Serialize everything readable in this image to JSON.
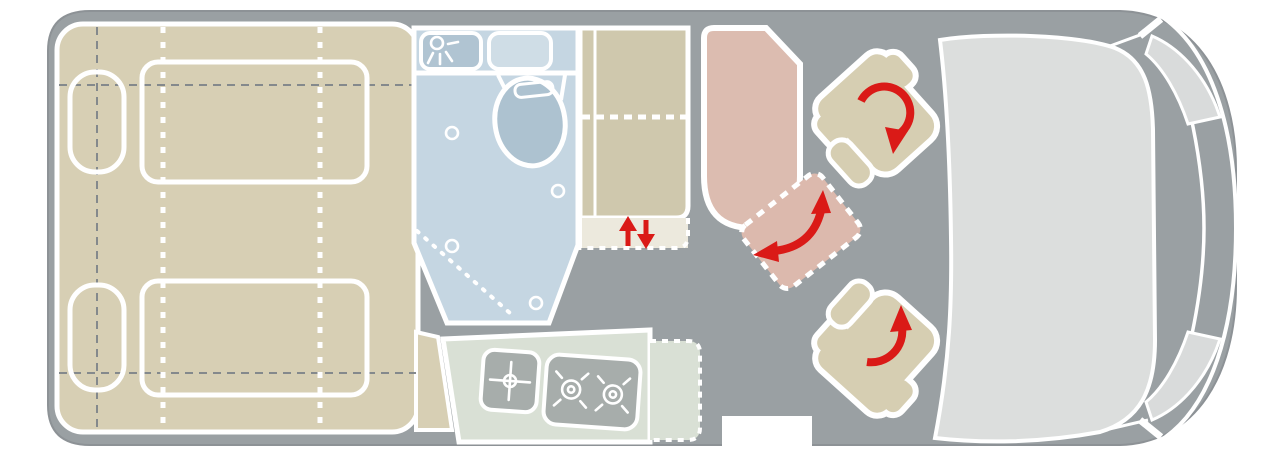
{
  "meta": {
    "title": "campervan-floor-plan",
    "view": "top-down floor plan of a camper van, cab at right, rear beds at left",
    "visible_text": "none"
  },
  "colors": {
    "background": "#ffffff",
    "van_body": "#9aa0a3",
    "van_edge": "#8d9296",
    "cab": "#dcdedd",
    "headlight": "#d9dbdb",
    "bed": "#d7cfb4",
    "seat": "#d6ceb2",
    "wardrobe": "#cfc8ad",
    "cabinet": "#ece9dd",
    "bathroom": "#c5d6e2",
    "fixture": "#b0c4d2",
    "shelf": "#cfdde6",
    "toilet": "#adc2d0",
    "kitchen": "#d9e0d5",
    "appliance": "#a7adab",
    "bench": "#dcbcb0",
    "table": "#dcb9ad",
    "red": "#da1a17",
    "dash_gray": "#84898c",
    "outline_white": "#ffffff"
  },
  "parts": [
    "van-body",
    "rear-bed-area",
    "bed-pillows",
    "bed-outlines",
    "fold-lines",
    "bathroom",
    "shower-control-box",
    "shower-icon",
    "bathroom-shelf",
    "toilet",
    "door-swing-dotted-line",
    "wardrobe",
    "lift-cabinet",
    "up-arrow-icon",
    "down-arrow-icon",
    "kitchen-block",
    "kitchen-worktop-extension",
    "sink",
    "faucet-cross-icon",
    "two-burner-stove",
    "burner-icons",
    "entry-door-opening",
    "dinette-bench",
    "dinette-table-dashed",
    "table-rotate-arrow-icon",
    "swivel-seat-passenger",
    "swivel-seat-driver",
    "seat-rotate-arrow-icons",
    "cab-windshield",
    "headlights",
    "bumper-lines"
  ]
}
